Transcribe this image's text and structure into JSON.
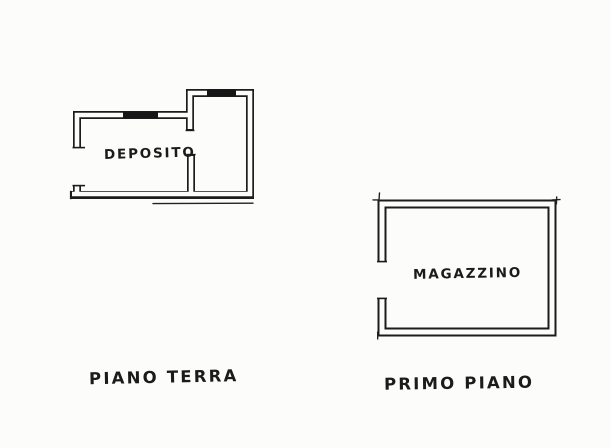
{
  "document": {
    "kind_label": "floor-plan-sketch",
    "background_color": "#fcfcfb",
    "ink_color": "#1c1c1c"
  },
  "plans": [
    {
      "room_label": "DEPOSITO",
      "caption": "PIANO TERRA"
    },
    {
      "room_label": "MAGAZZINO",
      "caption": "PRIMO PIANO"
    }
  ]
}
